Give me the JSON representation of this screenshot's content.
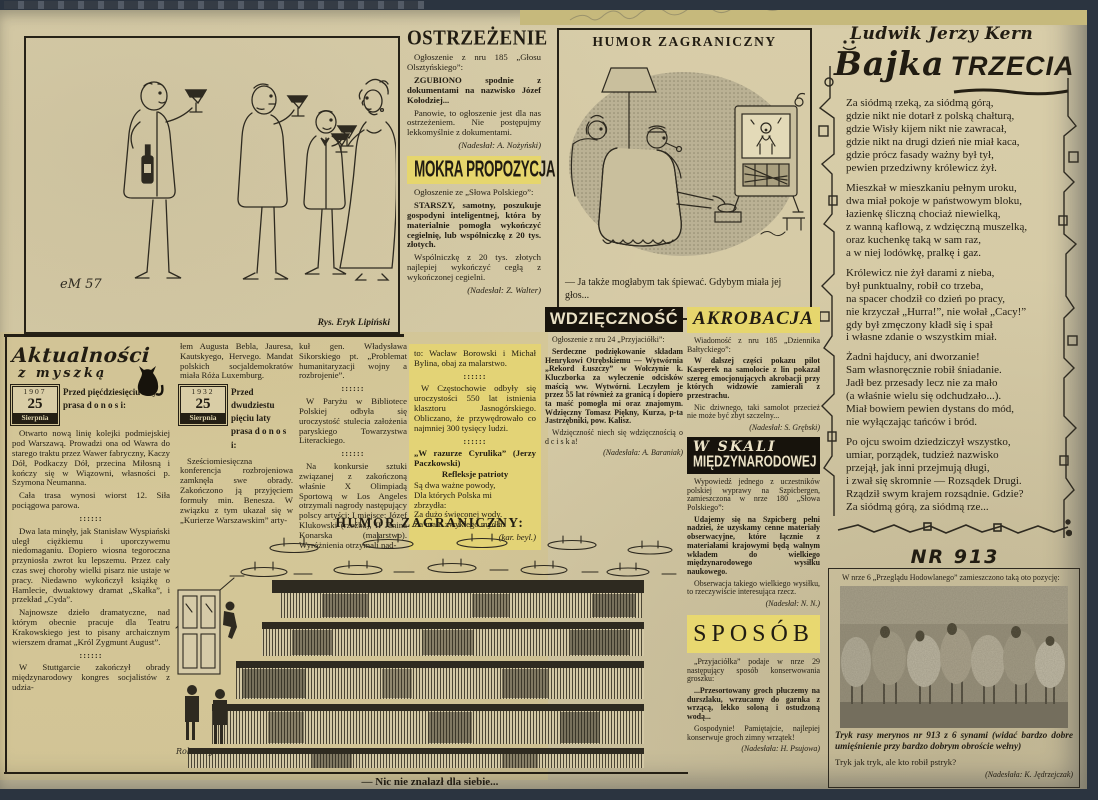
{
  "colors": {
    "paper": "#d6cba8",
    "ink": "#241f14",
    "highlight": "#e6d66d",
    "backing": "#2b3440"
  },
  "sep": "::::::",
  "toast_cartoon": {
    "signature": "eM 57",
    "credit": "Rys. Eryk Lipiński"
  },
  "ostrzezenie": {
    "title": "OSTRZEŻENIE",
    "intro": "Ogłoszenie z nru 185 „Głosu Olsztyńskiego”:",
    "bold_p": "ZGUBIONO spodnie z dokumentami na nazwisko Józef Kołodziej...",
    "p2": "Panowie, to ogłoszenie jest dla nas ostrzeżeniem. Nie postępujmy lekkomyślnie z dokumentami.",
    "credit": "(Nadesłał: A. Nożyński)"
  },
  "mokra": {
    "title": "MOKRA PROPOZYCJA",
    "intro": "Ogłoszenie ze „Słowa Polskiego”:",
    "bold_p": "STARSZY, samotny, poszukuje gospodyni inteligentnej, która by materialnie pomogła wykończyć cegielnię, lub wspólniczkę z 20 tys. złotych.",
    "p2": "Wspólniczkę z 20 tys. złotych najlepiej wykończyć cegłą z wykończonej cegielni.",
    "credit": "(Nadesłał: Z. Walter)"
  },
  "humor_tv": {
    "title": "HUMOR ZAGRANICZNY",
    "caption": "— Ja także mogłabym tak śpiewać. Gdybym miała jej głos..."
  },
  "bajka": {
    "author": "Ludwik Jerzy Kern",
    "title_script": "Bajka",
    "title_caps": "TRZECIA",
    "stanzas": [
      "Za siódmą rzeką, za siódmą górą,\ngdzie nikt nie dotarł z polską chałturą,\ngdzie Wisły kijem nikt nie zawracał,\ngdzie nikt na drugi dzień nie miał kaca,\ngdzie prócz fasady ważny był tył,\npewien przedziwny królewicz żył.",
      "Mieszkał w mieszkaniu pełnym uroku,\ndwa miał pokoje w państwowym bloku,\nłazienkę śliczną chociaż niewielką,\nz wanną kaflową, z wdzięczną muszelką,\noraz kuchenkę taką w sam raz,\na w niej lodówkę, pralkę i gaz.",
      "Królewicz nie żył darami z nieba,\nbył punktualny, robił co trzeba,\nna spacer chodził co dzień po pracy,\nnie krzyczał „Hurra!”, nie wołał „Cacy!”\ngdy był zmęczony kładł się i spał\ni własne zdanie o wszystkim miał.",
      "Żadni hajducy, ani dworzanie!\nSam własnoręcznie robił śniadanie.\nJadł bez przesady lecz nie za mało\n(a właśnie wielu się odchudzało...).\nMiał bowiem pewien dystans do mód,\nnie wyłączając tańców i bród.",
      "Po ojcu swoim dziedziczył wszystko,\numiar, porządek, tudzież nazwisko\nprzejął, jak inni przejmują długi,\ni zwał się skromnie — Rozsądek Drugi.\nRządził swym krajem rozsądnie. Gdzie?\nZa siódmą górą, za siódmą rze..."
    ]
  },
  "aktualnosci": {
    "logo1": "Aktualności",
    "logo2": "z myszką",
    "badge1": {
      "year": "1907",
      "day": "25",
      "month": "Sierpnia"
    },
    "lead1": "Przed pięćdziesięciu laty prasa d o n o s i:",
    "col1": [
      "Otwarto nową linię kolejki podmiejskiej pod Warszawą. Prowadzi ona od Wawra do starego traktu przez Wawer fabryczny, Kaczy Dół, Podkaczy Dół, przecina Miłosną i kończy się w Wiązowni, własności p. Szymona Neumanna.",
      "Cała trasa wynosi wiorst 12. Siła pociągowa parowa.",
      "Dwa lata minęły, jak Stanisław Wyspiański uległ ciężkiemu i uporczywemu niedomaganiu. Dopiero wiosna tegoroczna przyniosła zwrot ku lepszemu. Przez cały czas swej choroby wielki pisarz nie ustaje w pracy. Niedawno wykończył książkę o Hamlecie, dwuaktowy dramat „Skałka”, i przekład „Cyda”.",
      "Najnowsze dzieło dramatyczne, nad którym obecnie pracuje dla Teatru Krakowskiego jest to pisany archaicznym wierszem dramat „Król Zygmunt August”.",
      "W Stuttgarcie zakończył obrady międzynarodowy kongres socjalistów z udzia-"
    ],
    "col2a": "łem Augusta Bebla, Jauresa, Kautskyego, Hervego. Mandat polskich socjaldemokratów miała Róża Luxemburg.",
    "badge2": {
      "year": "1932",
      "day": "25",
      "month": "Sierpnia"
    },
    "lead2": "Przed dwudziestu pięciu laty prasa d o n o s i:",
    "col2b": "Sześciomiesięczna konferencja rozbrojeniowa zamknęła swe obrady. Zakończono ją przyjęciem formuły min. Benesza. W związku z tym ukazał się w „Kurierze Warszawskim” arty-",
    "col3": [
      "kuł gen. Władysława Sikorskiego pt. „Problemat humanitaryzacji wojny a rozbrojenie”.",
      "W Paryżu w Bibliotece Polskiej odbyła się uroczystość stulecia założenia paryskiego Towarzystwa Literackiego.",
      "Na konkursie sztuki związanej z zakończoną właśnie X Olimpiadą Sportową w Los Angeles otrzymali nagrody następujący polscy artyści: I miejsce: Józef Klukowski (rzeźba), II Janina Konarska (malarstwo). Wyróżnienia otrzymali nad-"
    ],
    "col4a": "to: Wacław Borowski i Michał Bylina, obaj za malarstwo.",
    "col4b": "W Częstochowie odbyły się uroczystości 550 lat istnienia klasztoru Jasnogórskiego. Obliczano, że przywędrowało co najmniej 300 tysięcy ludzi.",
    "verse_title": "„W razurze Cyrulika” (Jerzy Paczkowski)",
    "verse_sub": "Refleksje patrioty",
    "verse": "Są dwa ważne powody,\nDla których Polska mi\nzbrzydła:\nZa dużo święconej wody.\nZa mało zwykłego mydła.",
    "verse_credit": "(kar. beyl.)"
  },
  "wdziecznosc": {
    "title": "WDZIĘCZNOŚĆ",
    "intro": "Ogłoszenie z nru 24 „Przyjaciółki”:",
    "p1": "Serdeczne podziękowanie składam Henrykowi Otrębskiemu — Wytwórnia „Rekord Łuszczy” w Wołczynie k. Kluczborka za wyleczenie odcisków maścią ww. Wytwórni. Leczyłem je przez 55 lat również za granicą i dopiero ta maść pomogła mi oraz znajomym. Wdzięczny Tomasz Piękny, Kurza, p-ta Jastrzębniki, pow. Kalisz.",
    "p2": "Wdzięczność niech się wdzięcznością o d c i s k a!",
    "credit": "(Nadesłała: A. Baraniak)"
  },
  "akrobacja": {
    "title": "AKROBACJA",
    "intro": "Wiadomość z nru 185 „Dziennika Bałtyckiego”:",
    "p1": "W dalszej części pokazu pilot Kasperek na samolocie z lin pokazał szereg emocjonujących akrobacji przy których widzowie zamierali z przestrachu.",
    "p2": "Nic dziwnego, taki samolot przecież nie może być zbyt szczelny...",
    "credit": "(Nadesłał: S. Grębski)"
  },
  "w_skali": {
    "title1": "W SKALI",
    "title2": "MIĘDZYNARODOWEJ",
    "p1": "Wypowiedź jednego z uczestników polskiej wyprawy na Szpicbergen, zamieszczona w nrze 180 „Słowa Polskiego”:",
    "p2": "Udajemy się na Szpicberg pełni nadziei, że uzyskamy cenne materiały obserwacyjne, które łącznie z materiałami krajowymi będą walnym wkładem do wielkiego międzynarodowego wysiłku naukowego.",
    "p3": "Obserwacja takiego wielkiego wysiłku, to rzeczywiście interesująca rzecz.",
    "credit": "(Nadesłał: N. N.)"
  },
  "sposob": {
    "title": "SPOSÓB",
    "p1": "„Przyjaciółka” podaje w nrze 29 następujący sposób konserwowania groszku:",
    "p2": "...Przesortowany groch płuczemy na durszlaku, wrzucamy do garnka z wrzącą, lekko soloną i ostudzoną wodą...",
    "p3": "Gospodynie! Pamiętajcie, najlepiej konserwuje groch zimny wrzątek!",
    "credit": "(Nadesłała: H. Psujowa)"
  },
  "humor_store": {
    "header": "HUMOR ZAGRANICZNY:",
    "caption": "— Nic nie znalazł dla siebie...",
    "signature": "Robt Day"
  },
  "nr913": {
    "title": "NR 913",
    "intro": "W nrze 6 „Przeglądu Hodowlanego” zamieszczono taką oto pozycję:",
    "photo_caption": "Tryk rasy merynos nr 913 z 6 synami (widać bardzo dobre umięśnienie przy bardzo dobrym obroście wełny)",
    "p": "Tryk jak tryk, ale kto robił pstryk?",
    "credit": "(Nadesłała: K. Jędrzejczak)"
  }
}
